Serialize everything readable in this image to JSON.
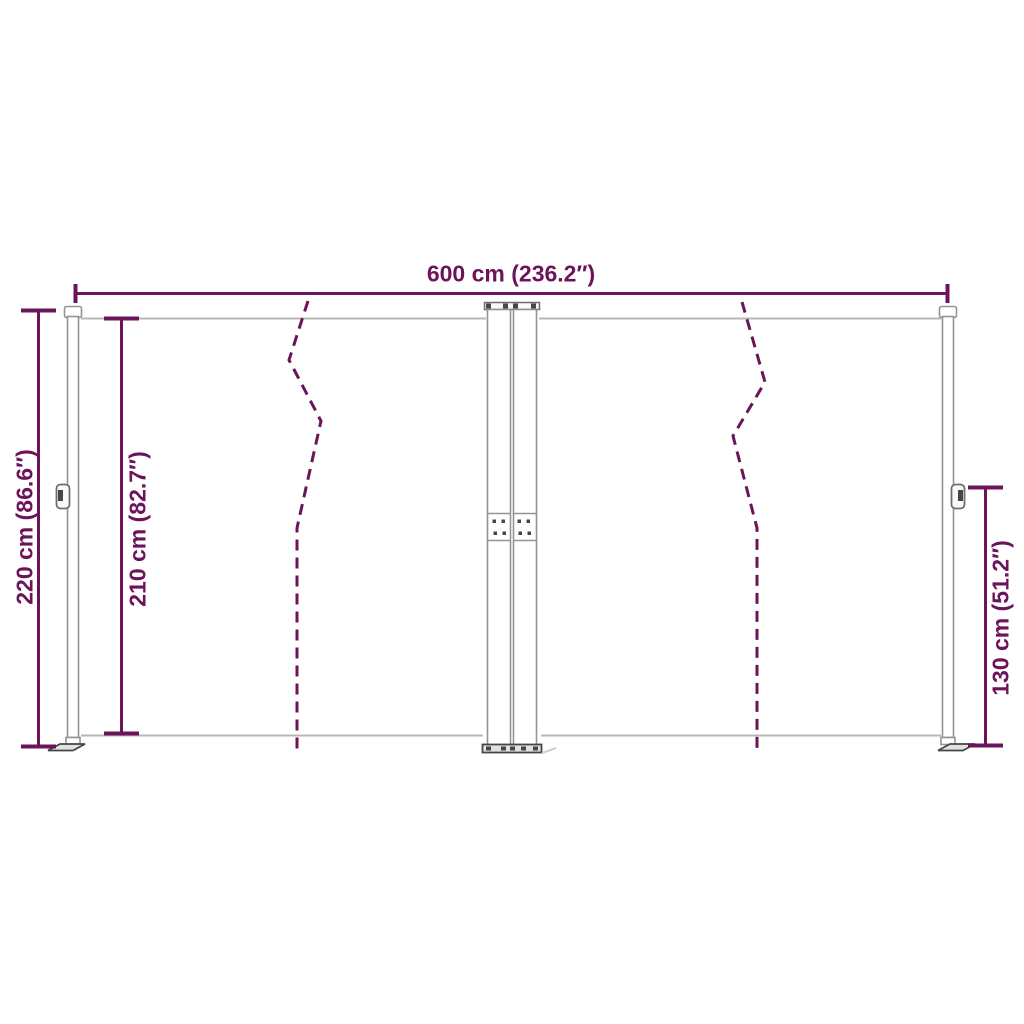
{
  "diagram_title": "Retractable double side awning dimension diagram",
  "colors": {
    "accent": "#6B145A",
    "frame_gray": "#949494",
    "rail_gray": "#b7b7b7",
    "detail_dark": "#464646"
  },
  "dimensions": {
    "total_width": {
      "label": "600 cm (236.2″)"
    },
    "left_height": {
      "label": "220 cm (86.6″)"
    },
    "inner_height": {
      "label": "210 cm (82.7″)"
    },
    "right_height": {
      "label": "130 cm (51.2″)"
    }
  }
}
